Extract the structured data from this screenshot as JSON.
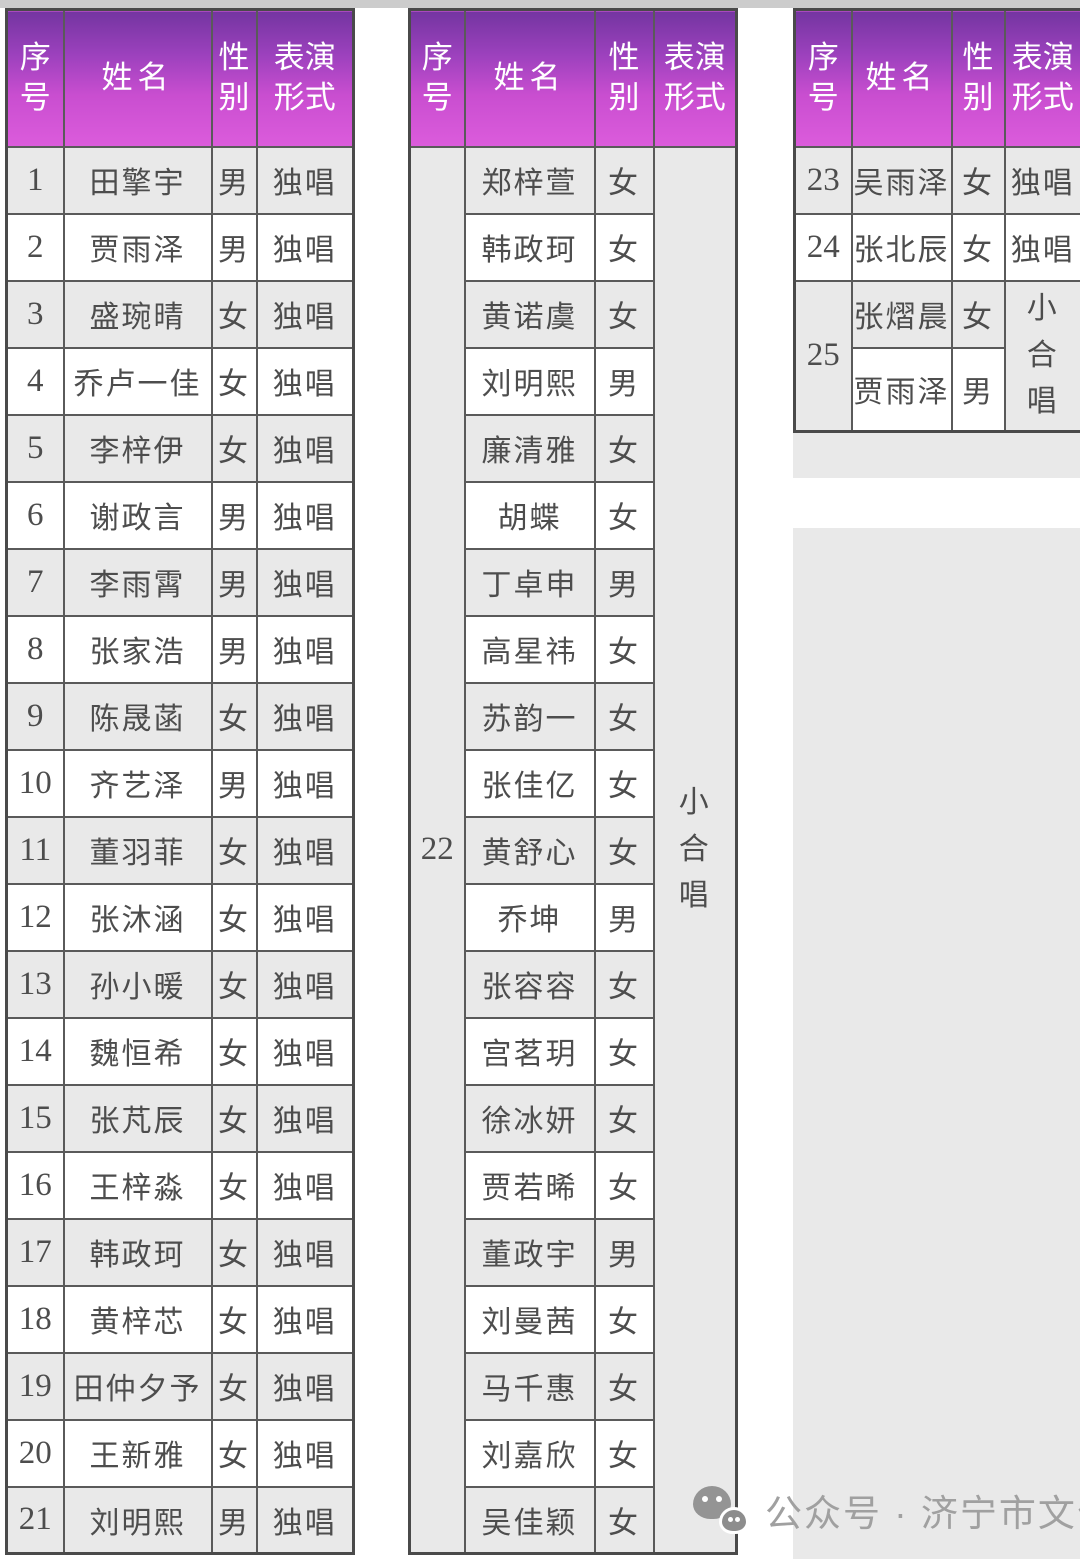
{
  "headers": {
    "no": "序\n号",
    "name": "姓名",
    "gender": "性\n别",
    "form": "表演\n形式"
  },
  "tables": {
    "solo": {
      "rows": [
        {
          "no": "1",
          "name": "田擎宇",
          "gender": "男",
          "form": "独唱"
        },
        {
          "no": "2",
          "name": "贾雨泽",
          "gender": "男",
          "form": "独唱"
        },
        {
          "no": "3",
          "name": "盛琬晴",
          "gender": "女",
          "form": "独唱"
        },
        {
          "no": "4",
          "name": "乔卢一佳",
          "gender": "女",
          "form": "独唱"
        },
        {
          "no": "5",
          "name": "李梓伊",
          "gender": "女",
          "form": "独唱"
        },
        {
          "no": "6",
          "name": "谢政言",
          "gender": "男",
          "form": "独唱"
        },
        {
          "no": "7",
          "name": "李雨霄",
          "gender": "男",
          "form": "独唱"
        },
        {
          "no": "8",
          "name": "张家浩",
          "gender": "男",
          "form": "独唱"
        },
        {
          "no": "9",
          "name": "陈晟菡",
          "gender": "女",
          "form": "独唱"
        },
        {
          "no": "10",
          "name": "齐艺泽",
          "gender": "男",
          "form": "独唱"
        },
        {
          "no": "11",
          "name": "董羽菲",
          "gender": "女",
          "form": "独唱"
        },
        {
          "no": "12",
          "name": "张沐涵",
          "gender": "女",
          "form": "独唱"
        },
        {
          "no": "13",
          "name": "孙小暖",
          "gender": "女",
          "form": "独唱"
        },
        {
          "no": "14",
          "name": "魏恒希",
          "gender": "女",
          "form": "独唱"
        },
        {
          "no": "15",
          "name": "张芃辰",
          "gender": "女",
          "form": "独唱"
        },
        {
          "no": "16",
          "name": "王梓淼",
          "gender": "女",
          "form": "独唱"
        },
        {
          "no": "17",
          "name": "韩政珂",
          "gender": "女",
          "form": "独唱"
        },
        {
          "no": "18",
          "name": "黄梓芯",
          "gender": "女",
          "form": "独唱"
        },
        {
          "no": "19",
          "name": "田仲夕予",
          "gender": "女",
          "form": "独唱"
        },
        {
          "no": "20",
          "name": "王新雅",
          "gender": "女",
          "form": "独唱"
        },
        {
          "no": "21",
          "name": "刘明熙",
          "gender": "男",
          "form": "独唱"
        }
      ]
    },
    "chorus22": {
      "no": "22",
      "form": "小合唱",
      "members": [
        {
          "name": "郑梓萱",
          "gender": "女"
        },
        {
          "name": "韩政珂",
          "gender": "女"
        },
        {
          "name": "黄诺虞",
          "gender": "女"
        },
        {
          "name": "刘明熙",
          "gender": "男"
        },
        {
          "name": "廉清雅",
          "gender": "女"
        },
        {
          "name": "胡蝶",
          "gender": "女"
        },
        {
          "name": "丁卓申",
          "gender": "男"
        },
        {
          "name": "高星祎",
          "gender": "女"
        },
        {
          "name": "苏韵一",
          "gender": "女"
        },
        {
          "name": "张佳亿",
          "gender": "女"
        },
        {
          "name": "黄舒心",
          "gender": "女"
        },
        {
          "name": "乔坤",
          "gender": "男"
        },
        {
          "name": "张容容",
          "gender": "女"
        },
        {
          "name": "宫茗玥",
          "gender": "女"
        },
        {
          "name": "徐冰妍",
          "gender": "女"
        },
        {
          "name": "贾若晞",
          "gender": "女"
        },
        {
          "name": "董政宇",
          "gender": "男"
        },
        {
          "name": "刘曼茜",
          "gender": "女"
        },
        {
          "name": "马千惠",
          "gender": "女"
        },
        {
          "name": "刘嘉欣",
          "gender": "女"
        },
        {
          "name": "吴佳颖",
          "gender": "女"
        }
      ]
    },
    "table3": {
      "rows": [
        {
          "no": "23",
          "name": "吴雨泽",
          "gender": "女",
          "form": "独唱"
        },
        {
          "no": "24",
          "name": "张北辰",
          "gender": "女",
          "form": "独唱"
        }
      ],
      "group": {
        "no": "25",
        "form": "小合唱",
        "members": [
          {
            "name": "张熠晨",
            "gender": "女"
          },
          {
            "name": "贾雨泽",
            "gender": "男"
          }
        ]
      }
    }
  },
  "watermark": {
    "icon": "wechat-icon",
    "text": "公众号 · 济宁市文化馆"
  },
  "colors": {
    "header_gradient_top": "#7435a1",
    "header_gradient_bottom": "#dc5cdc",
    "stripe": "#e9e9e9",
    "border": "#5a5a5a",
    "text": "#4d4d4d",
    "watermark": "#a0a0a0"
  }
}
